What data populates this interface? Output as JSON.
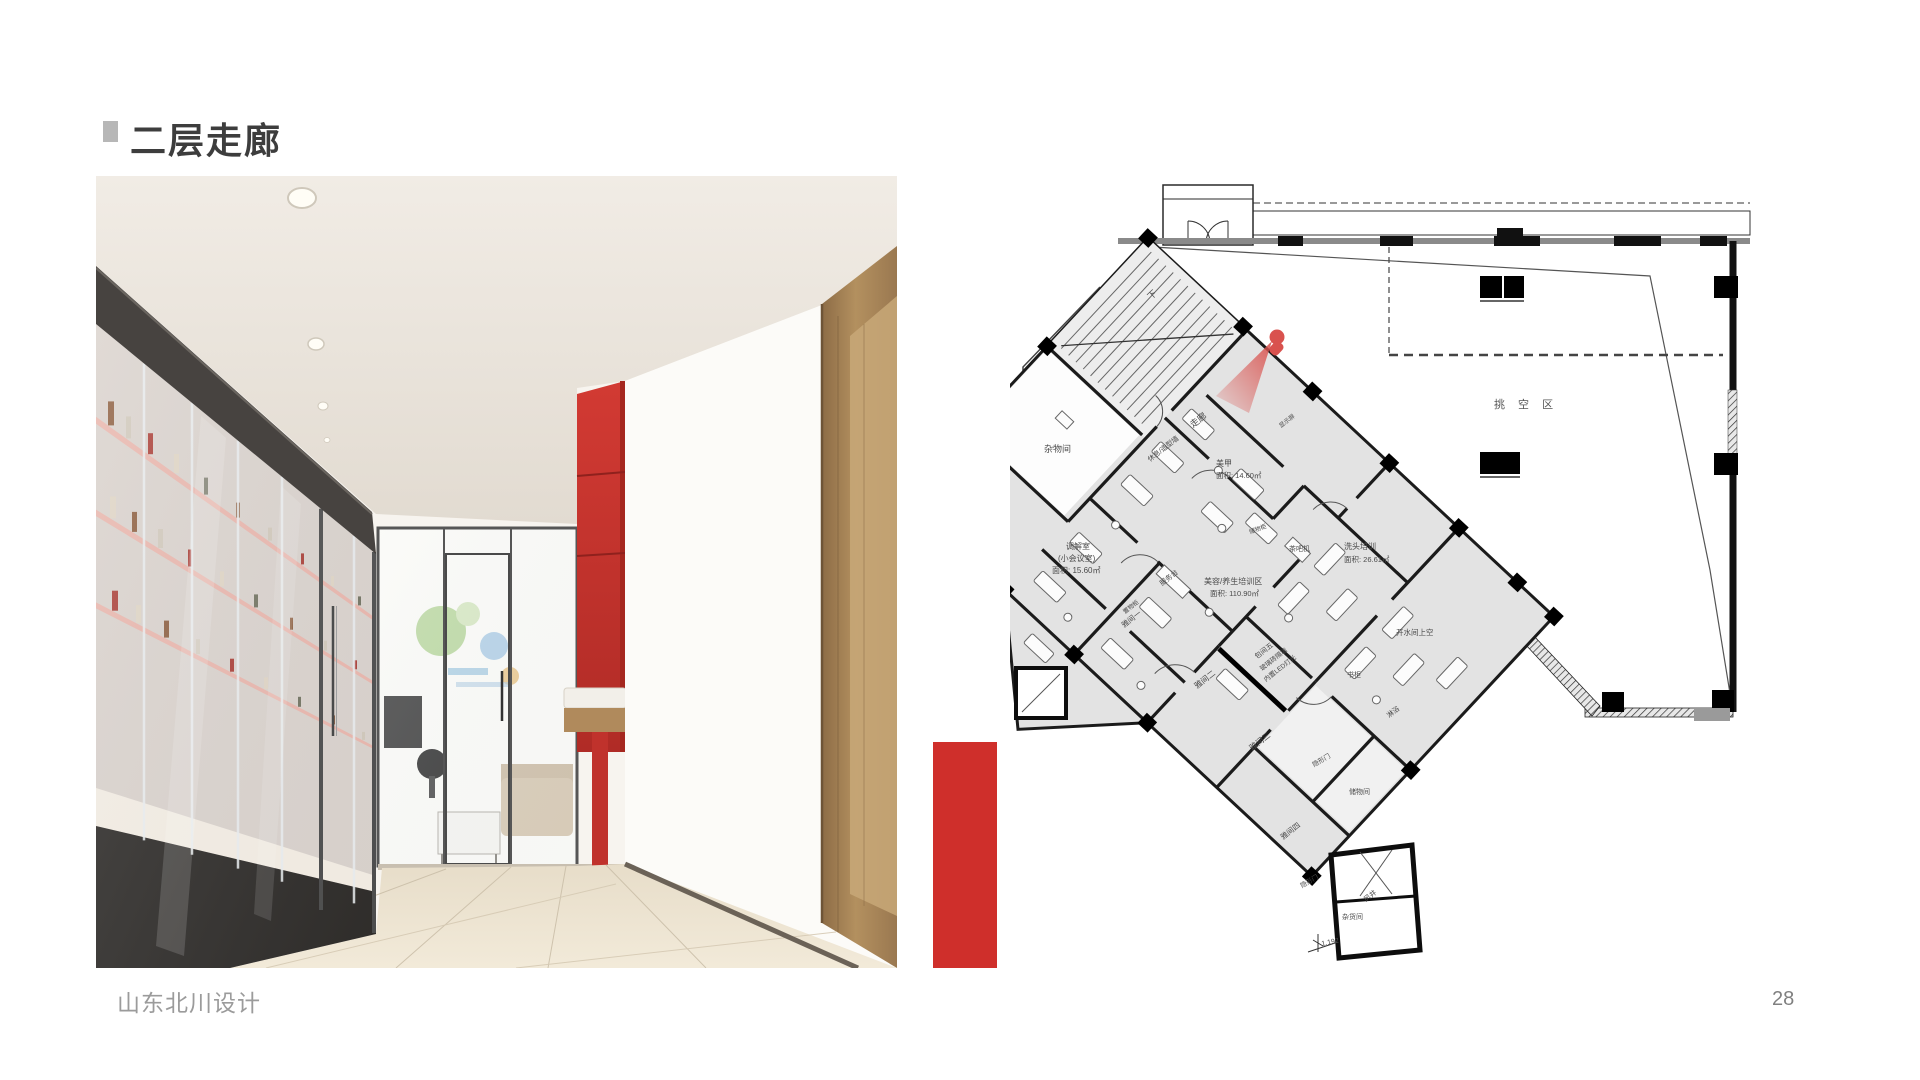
{
  "slide": {
    "title": "二层走廊",
    "footer": "山东北川设计",
    "page_number": "28"
  },
  "colors": {
    "accent_red": "#cf2f2b",
    "red_feature_wall": "#c5342f",
    "title_text": "#3d3d3d",
    "bullet_gray": "#b7b7b7",
    "footer_gray": "#9b9b9b",
    "plan_fill": "#e3e3e3",
    "plan_wall": "#1b1b1b",
    "view_cone_red": "#d9524e",
    "wood_frame": "#a9885e",
    "floor_beige": "#ece3d2"
  },
  "plan": {
    "void_area_label": "挑  空  区",
    "stair_label": "下",
    "labels": [
      {
        "text": "下",
        "x": 1151,
        "y": 300,
        "r": -43,
        "s": 9
      },
      {
        "text": "杂物间",
        "x": 1044,
        "y": 452,
        "r": 0,
        "s": 9
      },
      {
        "text": "走廊",
        "x": 1193,
        "y": 428,
        "r": -38,
        "s": 9
      },
      {
        "text": "休息/造型墙",
        "x": 1150,
        "y": 462,
        "r": -38,
        "s": 7
      },
      {
        "text": "显示屏",
        "x": 1281,
        "y": 428,
        "r": -38,
        "s": 6
      },
      {
        "text": "美甲",
        "x": 1216,
        "y": 466,
        "r": 0,
        "s": 8
      },
      {
        "text": "面积: 14.60㎡",
        "x": 1216,
        "y": 478,
        "r": 0,
        "s": 7.5
      },
      {
        "text": "调解室",
        "x": 1066,
        "y": 549,
        "r": 0,
        "s": 8
      },
      {
        "text": "(小会议室)",
        "x": 1058,
        "y": 561,
        "r": 0,
        "s": 8
      },
      {
        "text": "面积: 15.60㎡",
        "x": 1052,
        "y": 573,
        "r": 0,
        "s": 8
      },
      {
        "text": "服务台",
        "x": 1162,
        "y": 586,
        "r": -38,
        "s": 7
      },
      {
        "text": "美容/养生培训区",
        "x": 1204,
        "y": 584,
        "r": 0,
        "s": 8
      },
      {
        "text": "面积: 110.90㎡",
        "x": 1210,
        "y": 596,
        "r": 0,
        "s": 7.5
      },
      {
        "text": "茶吧机",
        "x": 1289,
        "y": 551,
        "r": 0,
        "s": 7
      },
      {
        "text": "储物柜",
        "x": 1250,
        "y": 534,
        "r": -20,
        "s": 6
      },
      {
        "text": "洗头培训",
        "x": 1344,
        "y": 549,
        "r": 0,
        "s": 8
      },
      {
        "text": "面积: 26.61㎡",
        "x": 1344,
        "y": 562,
        "r": 0,
        "s": 7.5
      },
      {
        "text": "置物柜",
        "x": 1125,
        "y": 614,
        "r": -38,
        "s": 6
      },
      {
        "text": "雅间一",
        "x": 1124,
        "y": 628,
        "r": -38,
        "s": 7.5
      },
      {
        "text": "雅间二",
        "x": 1197,
        "y": 689,
        "r": -38,
        "s": 8
      },
      {
        "text": "包间五",
        "x": 1257,
        "y": 659,
        "r": -38,
        "s": 7
      },
      {
        "text": "玻璃砖隔墙",
        "x": 1262,
        "y": 671,
        "r": -38,
        "s": 6.5
      },
      {
        "text": "内置LED灯光",
        "x": 1266,
        "y": 682,
        "r": -38,
        "s": 6.5
      },
      {
        "text": "书柜",
        "x": 1347,
        "y": 677,
        "r": 0,
        "s": 7
      },
      {
        "text": "雅间三",
        "x": 1252,
        "y": 751,
        "r": -38,
        "s": 8
      },
      {
        "text": "隐形门",
        "x": 1314,
        "y": 767,
        "r": -30,
        "s": 6.5
      },
      {
        "text": "储物间",
        "x": 1349,
        "y": 794,
        "r": 0,
        "s": 7
      },
      {
        "text": "雅间四",
        "x": 1283,
        "y": 840,
        "r": -38,
        "s": 7.5
      },
      {
        "text": "隐形门",
        "x": 1302,
        "y": 888,
        "r": -30,
        "s": 6.5
      },
      {
        "text": "淋浴",
        "x": 1389,
        "y": 718,
        "r": -38,
        "s": 7
      },
      {
        "text": "开水间上空",
        "x": 1396,
        "y": 635,
        "r": 0,
        "s": 7.5
      },
      {
        "text": "风井",
        "x": 1366,
        "y": 902,
        "r": -38,
        "s": 7
      },
      {
        "text": "杂货间",
        "x": 1342,
        "y": 919,
        "r": 0,
        "s": 7
      },
      {
        "text": "1.192",
        "x": 1322,
        "y": 946,
        "r": -12,
        "s": 7
      }
    ]
  }
}
